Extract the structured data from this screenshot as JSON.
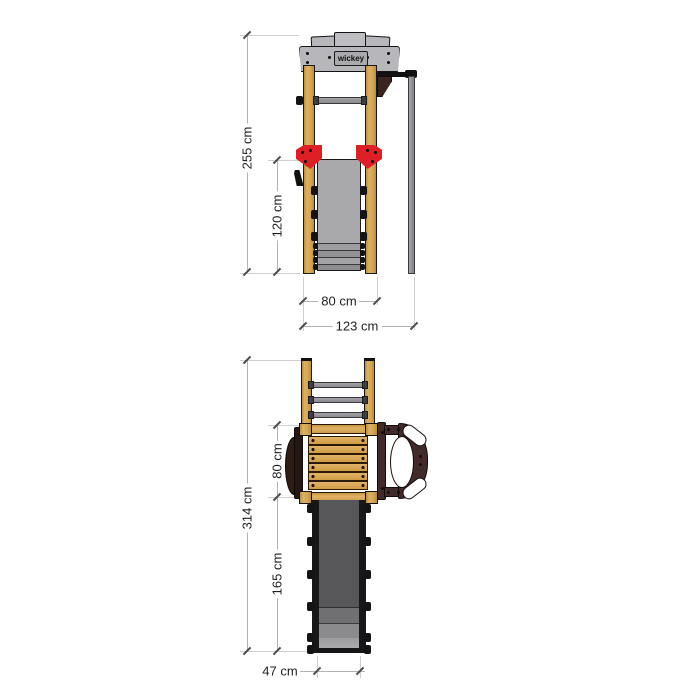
{
  "brand": {
    "logo_text": "wickey"
  },
  "front_view": {
    "dim_total_height": "255 cm",
    "dim_wall_height": "120 cm",
    "dim_inner_width": "80 cm",
    "dim_total_width": "123 cm"
  },
  "plan_view": {
    "dim_total_depth": "314 cm",
    "dim_platform_depth": "80 cm",
    "dim_slide_length": "165 cm",
    "dim_slide_width": "47 cm"
  },
  "colors": {
    "wood": "#d3a455",
    "frame_gray": "#b7b7bb",
    "metal_gray": "#8f8f93",
    "wall_gray": "#a9a9ab",
    "accent_red": "#dd1f26",
    "dark_brown": "#42292a",
    "slide_gray": "#57575a",
    "dimension_line": "#b3b3b3",
    "dimension_text": "#1f1f1f"
  }
}
